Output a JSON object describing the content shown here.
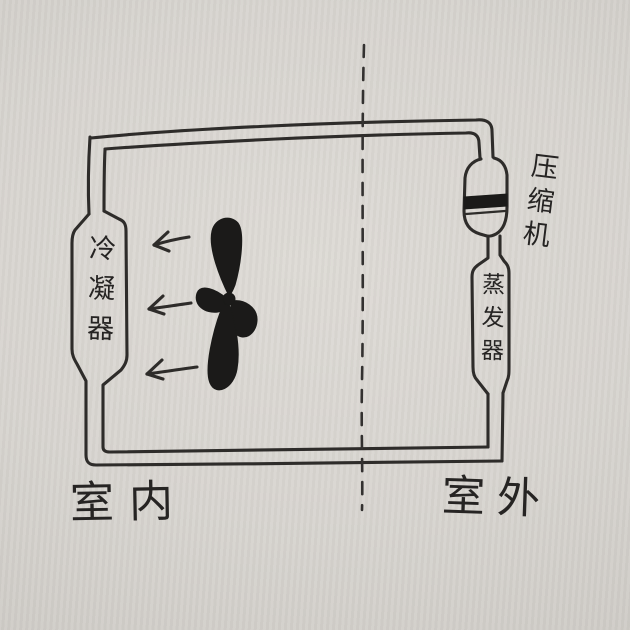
{
  "sketch": {
    "components": [
      {
        "id": "condenser",
        "label": "冷凝器",
        "position": "indoor-left",
        "shape": "capsule"
      },
      {
        "id": "compressor",
        "label": "压缩机",
        "position": "outdoor-top",
        "shape": "capsule-with-piston-band"
      },
      {
        "id": "evaporator",
        "label": "蒸发器",
        "position": "outdoor-right",
        "shape": "capsule"
      }
    ],
    "zones": [
      {
        "id": "indoor",
        "label": "室内"
      },
      {
        "id": "outdoor",
        "label": "室外"
      }
    ],
    "fan": {
      "blades": 4,
      "style": "solid-black-propeller"
    },
    "airflow_arrows": {
      "count": 3,
      "direction": "left"
    },
    "boundary_divider": {
      "orientation": "vertical",
      "style": "dashed"
    },
    "circuit": {
      "style": "double-line hand-drawn pipe loop"
    },
    "colors": {
      "ink": "#2e2c2a",
      "paper": "#d8d5d0"
    }
  }
}
